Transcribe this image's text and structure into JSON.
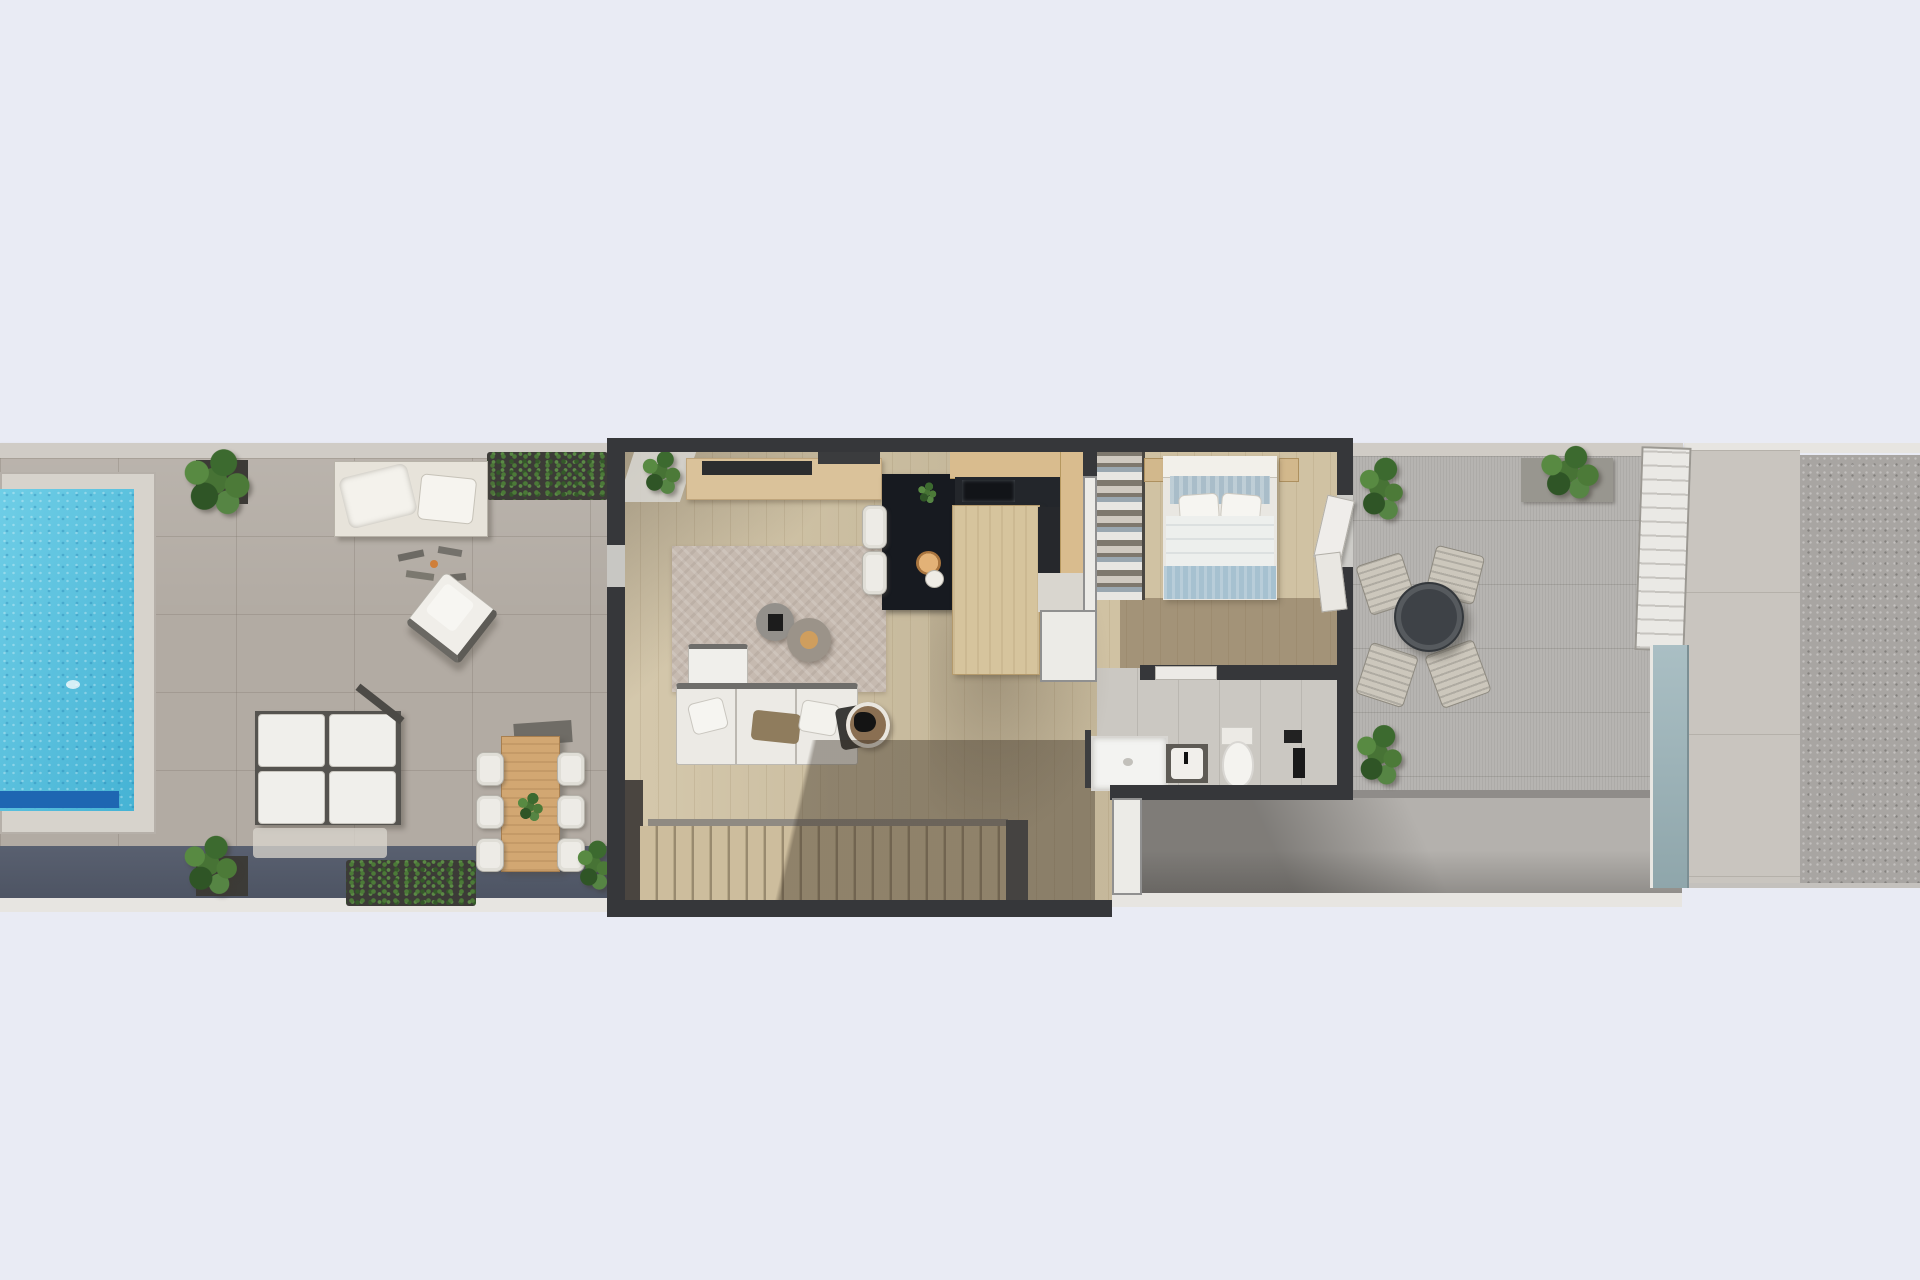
{
  "scene": {
    "title": "Top-down 3D render of a narrow townhouse floor plan",
    "view": "overhead architectural visualization, no text labels",
    "canvas_width": 1920,
    "canvas_height": 1280
  },
  "colors": {
    "background": "#e9ebf4",
    "terrace_tile": "#b2aba3",
    "terrace_top_band": "#d0ccc6",
    "terrace_ledge": "#596070",
    "terrace_trim": "#e7e5e1",
    "pool_coping": "#d7d3cc",
    "pool_water": "#4fc3e1",
    "pool_step": "#1e66b2",
    "wall_charcoal": "#36373a",
    "wall_white": "#ecebe7",
    "wood_floor": "#d0c2a3",
    "stair_tread": "#cdbd9d",
    "stair_tread_edge": "#b7a888",
    "rug": "#c6bab0",
    "sofa_white": "#f0efeb",
    "sofa_frame": "#6e6d6a",
    "throw_brown": "#8f7c5d",
    "blanket_dark": "#3a3a38",
    "pouf_gray": "#93908b",
    "island_dark": "#171a20",
    "cabinet_tan": "#d9bc8e",
    "counter_dark": "#23262b",
    "peninsula_tan": "#d6c49d",
    "chair_white": "#edebe6",
    "wardrobe_base": "#7e786e",
    "bed_headboard": "#f2f0ea",
    "bed_pillow_zone": "#a9bdc9",
    "bed_duvet": "#edefed",
    "bed_foot_blanket": "#a6c1d0",
    "nightstand_tan": "#d2b88c",
    "bath_floor": "#cbc8c2",
    "fixture_white": "#f3f3f1",
    "vanity_dark": "#5e5b55",
    "patio_gray": "#b4b1ad",
    "terrace_right": "#b6b4b1",
    "planter_dark": "#3c3b37",
    "planter_gray": "#98968f",
    "table_round_dark": "#3e4247",
    "chair_wood": "#ccc7bc",
    "glass_frame": "#eae9e5",
    "glass_pane": "#aabfc4",
    "walkway": "#c9c5bf",
    "gravel": "#a8a5a2",
    "dining_table_wood": "#d2a772"
  },
  "areas": {
    "pool_terrace": {
      "objects": [
        "swimming-pool",
        "pool-bench-step",
        "potted-plant",
        "hedge-planter",
        "daybed",
        "lounge-accessories",
        "armchair",
        "modular-lounge-set",
        "outdoor-dining-table",
        "dining-chairs",
        "bottom-planters"
      ],
      "dining_chair_count": 6,
      "lounge_cushion_count": 4
    },
    "living_room": {
      "objects": [
        "sideboard",
        "tv-panel",
        "area-rug",
        "poufs",
        "corner-sofa",
        "throw-blanket",
        "round-side-table",
        "indoor-plant"
      ],
      "pouf_count": 2
    },
    "kitchen": {
      "objects": [
        "dark-island",
        "island-plant",
        "wood-bowl",
        "bar-stools",
        "wall-cabinets",
        "dark-counter",
        "peninsula",
        "tall-unit"
      ],
      "bar_stool_count": 2
    },
    "bedroom": {
      "objects": [
        "double-bed",
        "pillows",
        "duvet",
        "foot-blanket",
        "open-wardrobe",
        "nightstands",
        "terrace-doors"
      ],
      "pillow_count": 2
    },
    "bathroom": {
      "objects": [
        "shower-tray",
        "glass-screen",
        "vanity-sink",
        "toilet",
        "towel-rail"
      ]
    },
    "staircase": {
      "objects": [
        "stair-treads",
        "handrail",
        "stair-shadow"
      ]
    },
    "rear_patio": {
      "objects": [
        "shaded-patio",
        "white-pillar"
      ]
    },
    "right_terrace": {
      "objects": [
        "round-bistro-table",
        "wood-chairs",
        "potted-plants",
        "planter-box",
        "glass-privacy-screen"
      ],
      "chair_count": 4
    },
    "side_strip": {
      "objects": [
        "paved-walkway",
        "gravel-band"
      ]
    }
  }
}
